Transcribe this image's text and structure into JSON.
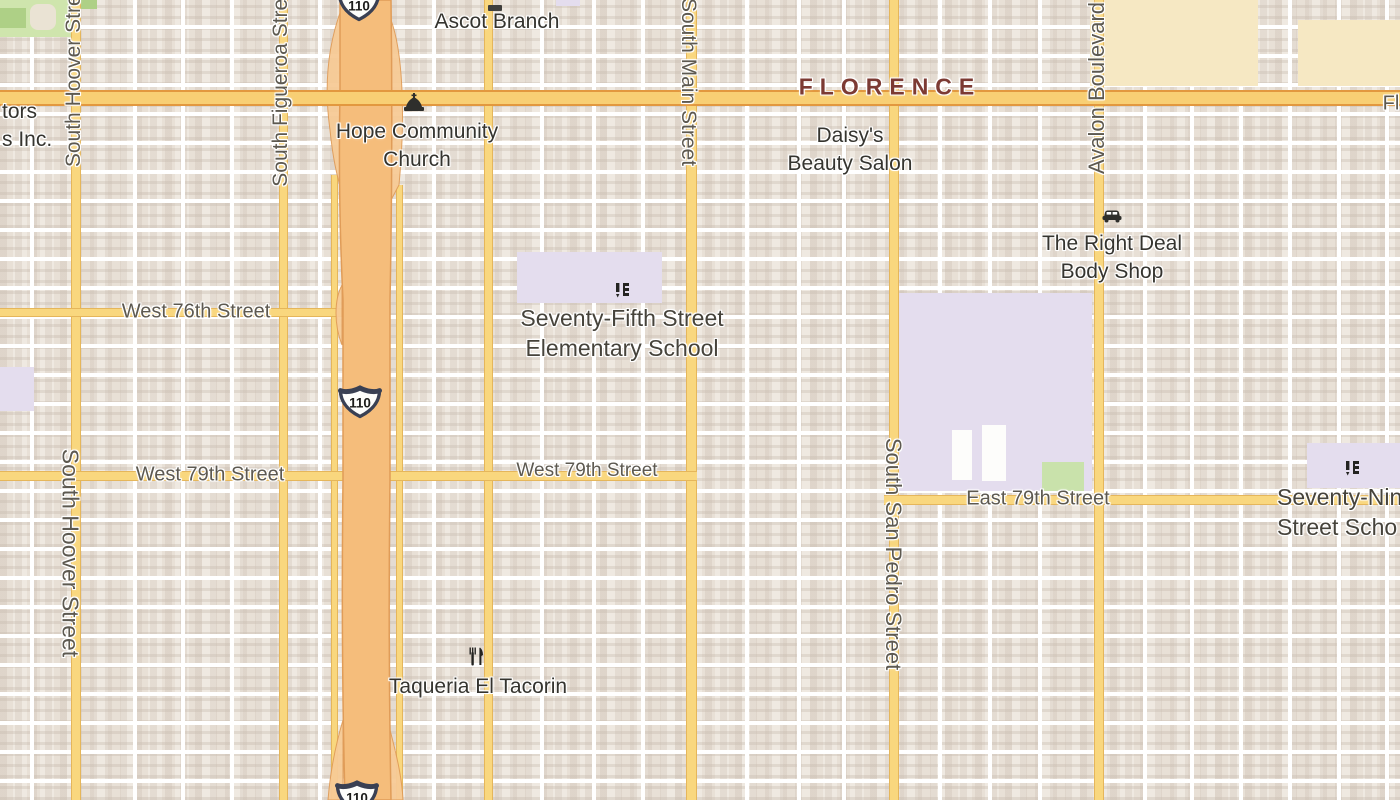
{
  "map": {
    "colors": {
      "land": "#efe9e1",
      "street_white": "#ffffff",
      "road_yellow": "#f9d77e",
      "road_yellow_casing": "#e5b65b",
      "florence_fill": "#f8cf74",
      "florence_casing": "#e2983f",
      "freeway_fill": "#f5bd7b",
      "freeway_casing": "#e09c58",
      "ramp_fill": "#f7cb96",
      "park": "#cfe5ad",
      "park_dark": "#aed086",
      "park_blob": "#eae3d4",
      "lavender": "#e4ddee",
      "lavender_green": "#c9e2ab",
      "wheat": "#f6e8c3",
      "white_building": "#fdfdfb",
      "street_label": "#5d5950",
      "poi_label": "#35342f",
      "school_label": "#46433b",
      "neighborhood_label": "#7c3a33",
      "shield_border": "#3a4053"
    },
    "areas": [
      {
        "name": "park-topleft",
        "kind": "park",
        "x": 0,
        "y": 0,
        "w": 80,
        "h": 37
      },
      {
        "name": "park-dark-patch-1",
        "kind": "park_dark",
        "x": 0,
        "y": 8,
        "w": 26,
        "h": 20
      },
      {
        "name": "park-dark-patch-2",
        "kind": "park_dark",
        "x": 80,
        "y": 0,
        "w": 17,
        "h": 9
      },
      {
        "name": "park-building",
        "kind": "park_blob",
        "x": 30,
        "y": 4,
        "w": 26,
        "h": 26,
        "r": 8
      },
      {
        "name": "retail-block-1",
        "kind": "wheat",
        "x": 1090,
        "y": 0,
        "w": 168,
        "h": 86
      },
      {
        "name": "retail-block-2",
        "kind": "wheat",
        "x": 1298,
        "y": 20,
        "w": 102,
        "h": 66
      },
      {
        "name": "school-grounds-75th",
        "kind": "lavender",
        "x": 517,
        "y": 252,
        "w": 145,
        "h": 51
      },
      {
        "name": "school-grounds-main",
        "kind": "lavender",
        "x": 899,
        "y": 293,
        "w": 193,
        "h": 198
      },
      {
        "name": "school-grounds-79th",
        "kind": "lavender",
        "x": 1307,
        "y": 443,
        "w": 93,
        "h": 45
      },
      {
        "name": "school-grounds-leftedge",
        "kind": "lavender",
        "x": 0,
        "y": 367,
        "w": 34,
        "h": 44
      },
      {
        "name": "school-grounds-topedge",
        "kind": "lavender",
        "x": 556,
        "y": 0,
        "w": 24,
        "h": 6
      },
      {
        "name": "school-field-green",
        "kind": "lavender_green",
        "x": 1042,
        "y": 462,
        "w": 42,
        "h": 29
      },
      {
        "name": "school-building-1",
        "kind": "white_building",
        "x": 952,
        "y": 430,
        "w": 20,
        "h": 50
      },
      {
        "name": "school-building-2",
        "kind": "white_building",
        "x": 982,
        "y": 425,
        "w": 24,
        "h": 56
      }
    ],
    "white_vertical_streets": [
      30,
      133,
      181,
      230,
      318,
      432,
      540,
      592,
      641,
      745,
      797,
      842,
      938,
      988,
      1038,
      1143,
      1190,
      1239,
      1288,
      1337,
      1385
    ],
    "roads": {
      "vertical_yellow": [
        {
          "name": "south-hoover-street-road",
          "x": 71,
          "w": 8,
          "y0": 0,
          "y1": 800
        },
        {
          "name": "south-figueroa-street-road",
          "x": 279,
          "w": 7,
          "y0": 0,
          "y1": 800
        },
        {
          "name": "freeway-frontage-west",
          "x": 331,
          "w": 5,
          "y0": 175,
          "y1": 800
        },
        {
          "name": "freeway-frontage-east",
          "x": 396,
          "w": 5,
          "y0": 185,
          "y1": 800
        },
        {
          "name": "unnamed-avenue-road",
          "x": 484,
          "w": 7,
          "y0": 0,
          "y1": 800
        },
        {
          "name": "south-main-street-road",
          "x": 686,
          "w": 9,
          "y0": 0,
          "y1": 800
        },
        {
          "name": "south-san-pedro-street-road",
          "x": 889,
          "w": 8,
          "y0": 0,
          "y1": 800
        },
        {
          "name": "avalon-boulevard-road",
          "x": 1094,
          "w": 8,
          "y0": 0,
          "y1": 800
        }
      ],
      "horizontal_yellow": [
        {
          "name": "west-76th-street-road",
          "y": 308,
          "h": 7,
          "x0": 0,
          "x1": 348
        },
        {
          "name": "west-79th-street-road",
          "y": 471,
          "h": 8,
          "x0": 0,
          "x1": 697
        },
        {
          "name": "east-79th-street-road",
          "y": 495,
          "h": 8,
          "x0": 884,
          "x1": 1400
        }
      ],
      "florence_avenue": {
        "name": "florence-avenue-road",
        "y": 90,
        "h": 12,
        "x0": 0,
        "x1": 1400
      }
    },
    "freeway": {
      "main_path": "M340,0 L340,92 Q338,200 343,300 L343,480 Q341,650 345,800 L391,800 Q388,640 390,480 L390,300 Q393,150 391,0 Z",
      "ramp_paths": [
        "M341,10 C330,40 323,80 330,130 C333,160 337,175 341,190 L341,60 Z",
        "M391,20 C402,50 406,110 399,185 L391,200 Z",
        "M343,720 C334,750 330,775 328,800 L343,800 Z",
        "M390,730 C398,760 402,780 403,800 L390,800 Z",
        "M342,285 C334,300 334,325 342,345 Z"
      ]
    },
    "shields": [
      {
        "name": "route-shield-110-top",
        "text": "110",
        "x": 359,
        "y": 5
      },
      {
        "name": "route-shield-110-middle",
        "text": "110",
        "x": 360,
        "y": 402
      },
      {
        "name": "route-shield-110-bottom",
        "text": "110",
        "x": 357,
        "y": 797
      }
    ],
    "labels": [
      {
        "name": "neighborhood-label-florence",
        "type": "neigh",
        "text": "FLORENCE",
        "x": 890,
        "y": 87
      },
      {
        "name": "street-label-west-76th",
        "type": "street",
        "text": "West 76th Street",
        "x": 196,
        "y": 312,
        "size": 20
      },
      {
        "name": "street-label-west-79th-a",
        "type": "street",
        "text": "West 79th Street",
        "x": 210,
        "y": 475,
        "size": 20
      },
      {
        "name": "street-label-west-79th-b",
        "type": "street",
        "text": "West 79th Street",
        "x": 587,
        "y": 471,
        "size": 19
      },
      {
        "name": "street-label-east-79th",
        "type": "street",
        "text": "East 79th Street",
        "x": 1038,
        "y": 499,
        "size": 20
      },
      {
        "name": "street-label-fl-cut",
        "type": "street",
        "text": "Fl",
        "x": 1391,
        "y": 104,
        "size": 20
      },
      {
        "name": "street-label-south-hoover-north",
        "type": "street-v-up",
        "text": "South Hoover Street",
        "x": 74,
        "y": 72,
        "size": 21
      },
      {
        "name": "street-label-south-hoover-south",
        "type": "street-v-down",
        "text": "South Hoover Street",
        "x": 70,
        "y": 553,
        "size": 23
      },
      {
        "name": "street-label-south-figueroa",
        "type": "street-v-up",
        "text": "South Figueroa Street",
        "x": 281,
        "y": 84,
        "size": 21
      },
      {
        "name": "street-label-south-main",
        "type": "street-v-down",
        "text": "South Main Street",
        "x": 688,
        "y": 82,
        "size": 21
      },
      {
        "name": "street-label-south-san-pedro",
        "type": "street-v-down",
        "text": "South San Pedro Street",
        "x": 893,
        "y": 554,
        "size": 22
      },
      {
        "name": "street-label-avalon-boulevard",
        "type": "street-v-up",
        "text": "Avalon Boulevard",
        "x": 1097,
        "y": 88,
        "size": 22
      },
      {
        "name": "poi-label-ascot-branch",
        "type": "poi",
        "lines": [
          "Ascot Branch"
        ],
        "x": 497,
        "y": 22
      },
      {
        "name": "poi-label-hope-community-church",
        "type": "poi",
        "lines": [
          "Hope Community",
          "Church"
        ],
        "x": 417,
        "y": 146
      },
      {
        "name": "poi-label-daisys-beauty-salon",
        "type": "poi",
        "lines": [
          "Daisy's",
          "Beauty Salon"
        ],
        "x": 850,
        "y": 150
      },
      {
        "name": "poi-label-right-deal-body-shop",
        "type": "poi",
        "lines": [
          "The Right Deal",
          "Body Shop"
        ],
        "x": 1112,
        "y": 258
      },
      {
        "name": "poi-label-taqueria-el-tacorin",
        "type": "poi",
        "lines": [
          "Taqueria El Tacorin"
        ],
        "x": 478,
        "y": 687
      },
      {
        "name": "poi-label-tors-inc",
        "type": "poi-left",
        "lines": [
          "tors",
          "s Inc."
        ],
        "x": 2,
        "y": 126
      },
      {
        "name": "school-label-seventy-fifth",
        "type": "school",
        "lines": [
          "Seventy-Fifth Street",
          "Elementary School"
        ],
        "x": 622,
        "y": 333
      },
      {
        "name": "school-label-seventy-ninth",
        "type": "school-left",
        "lines": [
          "Seventy-Nin",
          "Street Scho"
        ],
        "x": 1277,
        "y": 512
      }
    ],
    "icons": [
      {
        "name": "church-icon",
        "x": 414,
        "y": 103
      },
      {
        "name": "car-icon",
        "x": 1112,
        "y": 215
      },
      {
        "name": "school-icon",
        "x": 622,
        "y": 290
      },
      {
        "name": "school-icon",
        "x": 1352,
        "y": 468
      },
      {
        "name": "restaurant-icon",
        "x": 476,
        "y": 656
      },
      {
        "name": "library-icon-fragment",
        "x": 495,
        "y": 2
      }
    ]
  }
}
